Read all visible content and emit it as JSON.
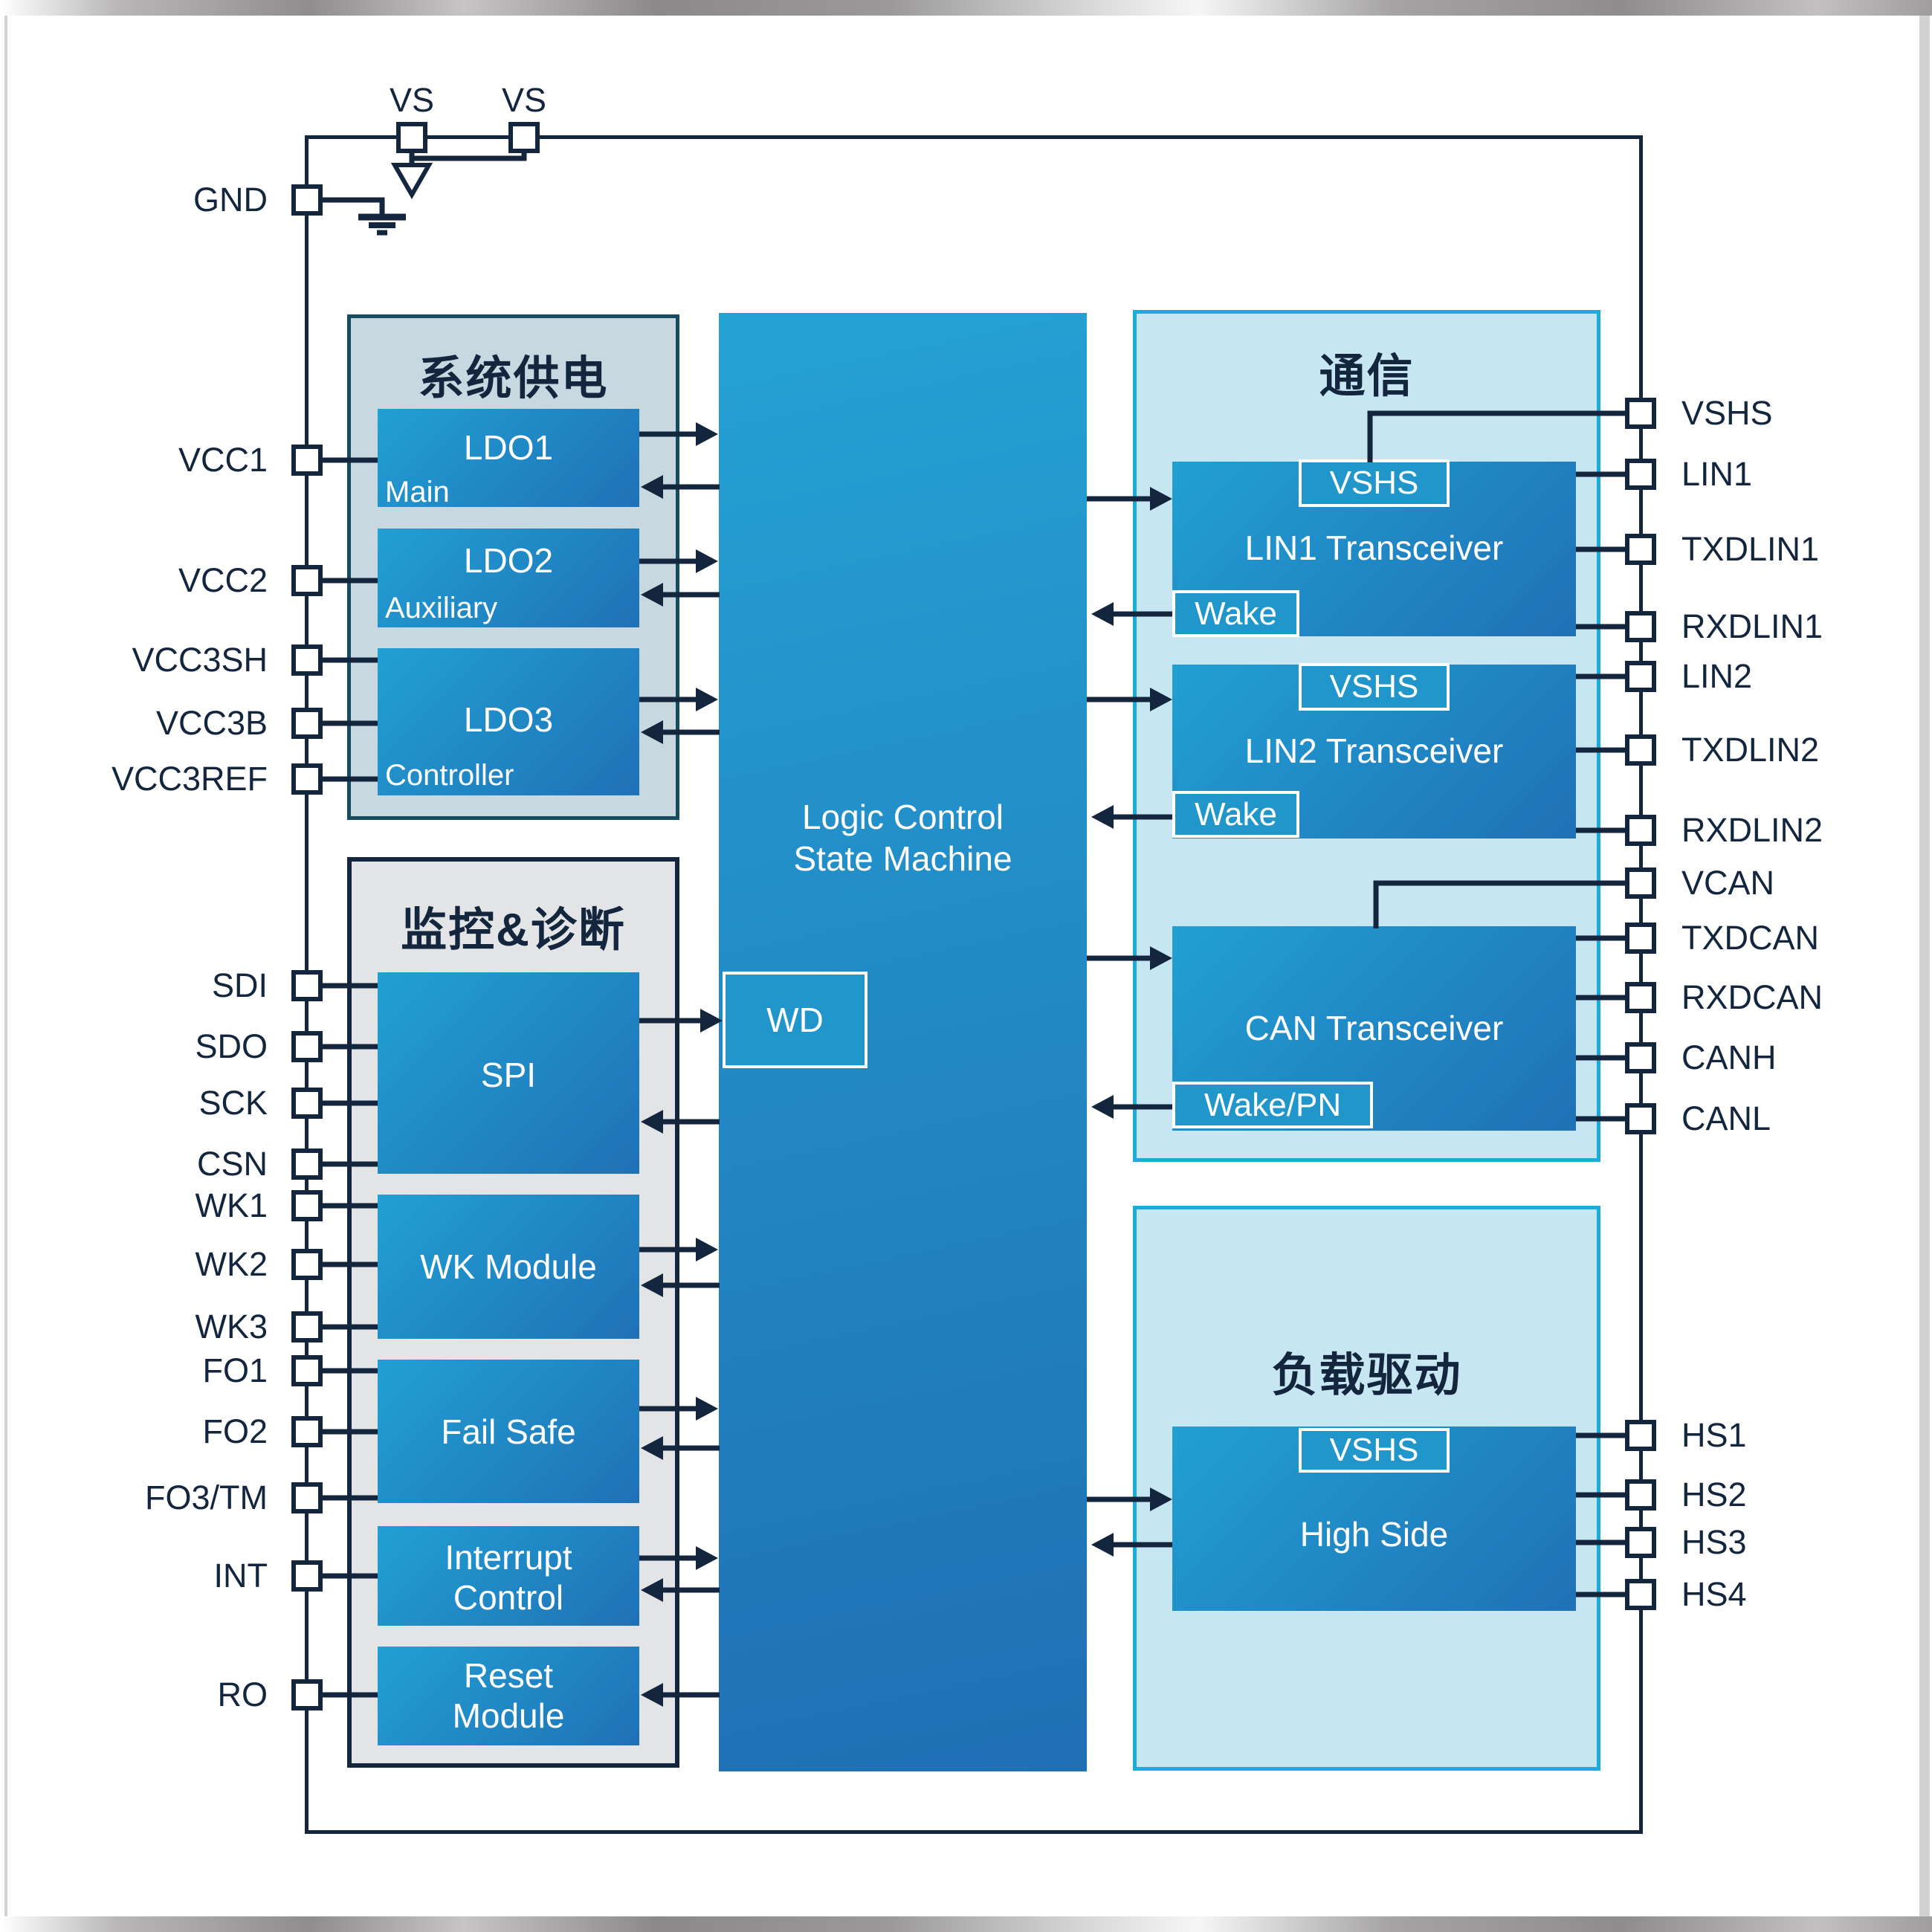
{
  "diagram_title": "SBC 功能框图",
  "pins": {
    "top": [
      {
        "label": "VS"
      },
      {
        "label": "VS"
      }
    ],
    "left": [
      {
        "label": "GND"
      },
      {
        "label": "VCC1"
      },
      {
        "label": "VCC2"
      },
      {
        "label": "VCC3SH"
      },
      {
        "label": "VCC3B"
      },
      {
        "label": "VCC3REF"
      },
      {
        "label": "SDI"
      },
      {
        "label": "SDO"
      },
      {
        "label": "SCK"
      },
      {
        "label": "CSN"
      },
      {
        "label": "WK1"
      },
      {
        "label": "WK2"
      },
      {
        "label": "WK3"
      },
      {
        "label": "FO1"
      },
      {
        "label": "FO2"
      },
      {
        "label": "FO3/TM"
      },
      {
        "label": "INT"
      },
      {
        "label": "RO"
      }
    ],
    "right": [
      {
        "label": "VSHS"
      },
      {
        "label": "LIN1"
      },
      {
        "label": "TXDLIN1"
      },
      {
        "label": "RXDLIN1"
      },
      {
        "label": "LIN2"
      },
      {
        "label": "TXDLIN2"
      },
      {
        "label": "RXDLIN2"
      },
      {
        "label": "VCAN"
      },
      {
        "label": "TXDCAN"
      },
      {
        "label": "RXDCAN"
      },
      {
        "label": "CANH"
      },
      {
        "label": "CANL"
      },
      {
        "label": "HS1"
      },
      {
        "label": "HS2"
      },
      {
        "label": "HS3"
      },
      {
        "label": "HS4"
      }
    ]
  },
  "groups": {
    "power": {
      "title": "系统供电",
      "blocks": [
        {
          "name": "LDO1",
          "subtitle": "Main"
        },
        {
          "name": "LDO2",
          "subtitle": "Auxiliary"
        },
        {
          "name": "LDO3",
          "subtitle": "Controller"
        }
      ]
    },
    "monitor": {
      "title": "监控&诊断",
      "blocks": [
        {
          "name": "SPI"
        },
        {
          "name": "WK Module"
        },
        {
          "name": "Fail Safe"
        },
        {
          "name": "Interrupt Control"
        },
        {
          "name": "Reset Module"
        }
      ]
    },
    "comm": {
      "title": "通信",
      "blocks": [
        {
          "name": "LIN1 Transceiver",
          "supply_tag": "VSHS",
          "wake_tag": "Wake"
        },
        {
          "name": "LIN2 Transceiver",
          "supply_tag": "VSHS",
          "wake_tag": "Wake"
        },
        {
          "name": "CAN Transceiver",
          "wake_tag": "Wake/PN"
        }
      ]
    },
    "load": {
      "title": "负载驱动",
      "blocks": [
        {
          "name": "High Side",
          "supply_tag": "VSHS"
        }
      ]
    }
  },
  "center": {
    "logic_line1": "Logic Control",
    "logic_line2": "State Machine",
    "watchdog": "WD"
  },
  "colors": {
    "navy": "#14263e",
    "teal": "#1cabdb",
    "cyanfill": "#c6e7f2",
    "slatefill": "#c8d8e0",
    "slateborder": "#174b60",
    "grayfill": "#e3e4e6",
    "blocka": "#21a0d4",
    "blockb": "#2071b6",
    "logica": "#25a2d4",
    "logicb": "#1f6fb5",
    "tagfill": "#2196cb",
    "frame": "#d2d2d2"
  }
}
